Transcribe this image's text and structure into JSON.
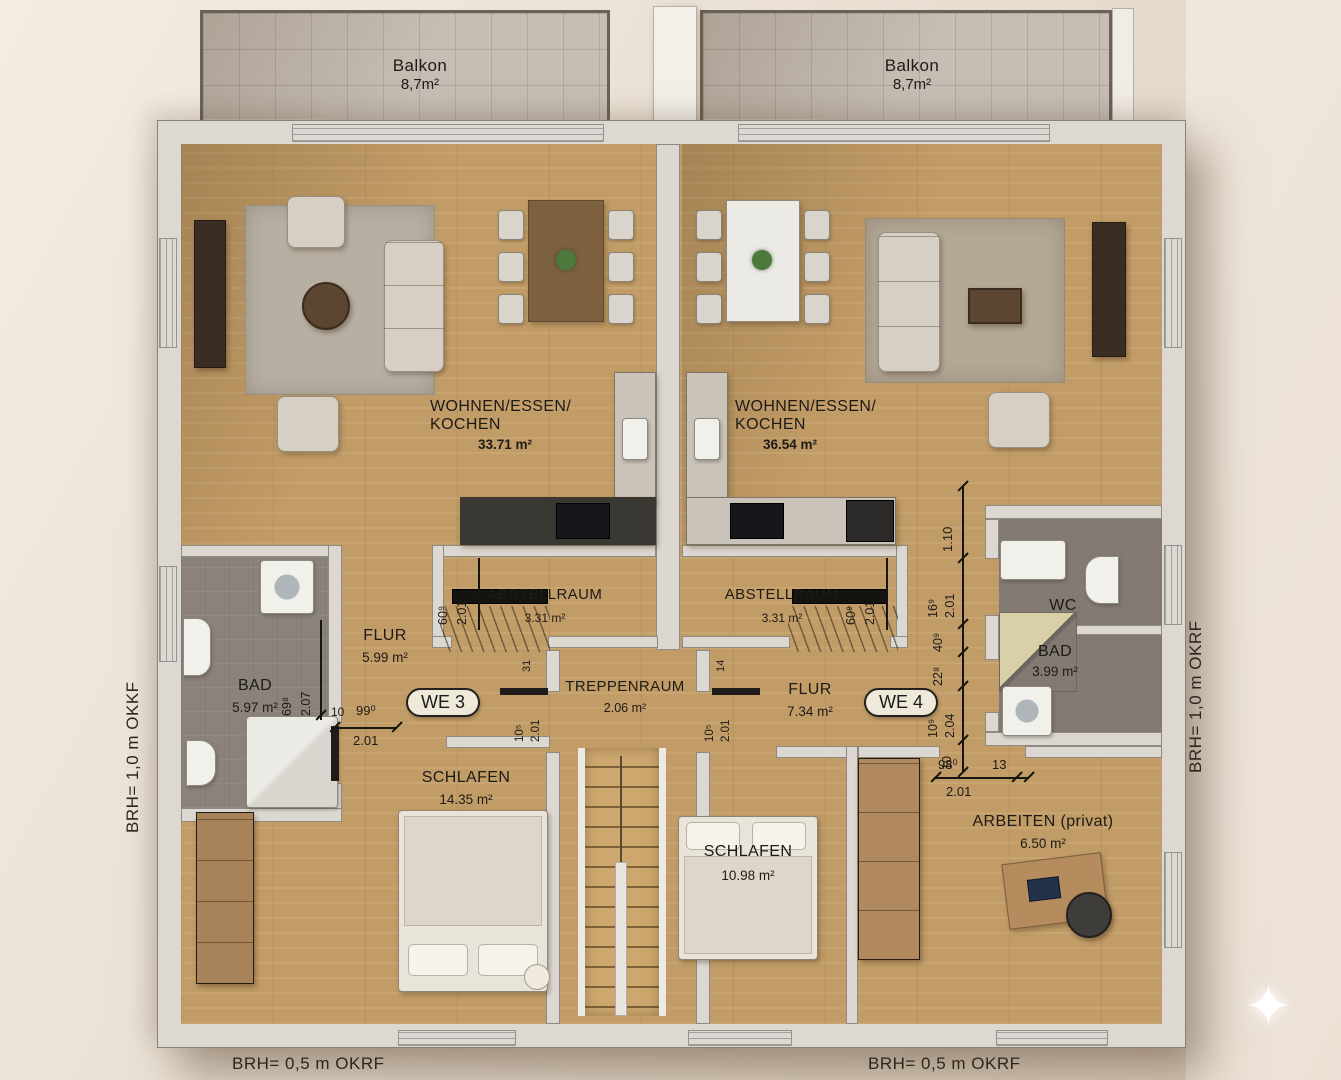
{
  "balconies": {
    "left": {
      "name": "Balkon",
      "area": "8,7m²"
    },
    "right": {
      "name": "Balkon",
      "area": "8,7m²"
    }
  },
  "units": {
    "left": "WE 3",
    "right": "WE 4"
  },
  "rooms": {
    "living_left": {
      "name1": "WOHNEN/ESSEN/",
      "name2": "KOCHEN",
      "area": "33.71 m²"
    },
    "living_right": {
      "name1": "WOHNEN/ESSEN/",
      "name2": "KOCHEN",
      "area": "36.54 m²"
    },
    "abstell_left": {
      "name": "ABSTELLRAUM",
      "area": "3.31 m²"
    },
    "abstell_right": {
      "name": "ABSTELLRAUM",
      "area": "3.31 m²"
    },
    "flur_left": {
      "name": "FLUR",
      "area": "5.99 m²"
    },
    "flur_right": {
      "name": "FLUR",
      "area": "7.34 m²"
    },
    "bad_left": {
      "name": "BAD",
      "area": "5.97 m²"
    },
    "bad_right": {
      "name": "BAD",
      "area": "3.99 m²"
    },
    "wc_right": {
      "name": "WC"
    },
    "treppenraum": {
      "name": "TREPPENRAUM",
      "area": "2.06 m²"
    },
    "schlafen_left": {
      "name": "SCHLAFEN",
      "area": "14.35 m²"
    },
    "schlafen_right": {
      "name": "SCHLAFEN",
      "area": "10.98 m²"
    },
    "arbeiten": {
      "name": "ARBEITEN (privat)",
      "area": "6.50 m²"
    }
  },
  "dims": {
    "abstell_left_w": "60⁹",
    "abstell_left_h": "2.01",
    "abstell_right_w": "60⁹",
    "abstell_right_h": "2.01",
    "bad_left_w": "69⁸",
    "bad_left_h": "2.07",
    "schlafen_left_off": "10",
    "schlafen_left_w": "99⁰",
    "schlafen_left_h": "2.01",
    "stair_left_off": "31",
    "stair_left_w": "10⁵",
    "stair_left_h": "2.01",
    "stair_right_off": "14",
    "stair_right_w": "10⁵",
    "stair_right_h": "2.01",
    "chain_top": "1.10",
    "chain_w1": "16⁹",
    "chain_h1": "2.01",
    "chain_w2": "40⁹",
    "chain_w3": "22⁸",
    "chain_w4": "10⁹",
    "chain_h4": "2.04",
    "chain_off": "10",
    "arbeiten_w": "98⁰",
    "arbeiten_off": "13",
    "arbeiten_h": "2.01"
  },
  "notes": {
    "left_side": "BRH= 1,0 m OKKF",
    "right_side": "BRH= 1,0 m OKRF",
    "bottom_left": "BRH= 0,5 m OKRF",
    "bottom_right": "BRH= 0,5 m OKRF"
  },
  "icons": {
    "sparkle": "✦"
  },
  "colors": {
    "wood_floor": "#c29c66",
    "bath_floor": "#8b837b",
    "wall": "#dcd8d1",
    "balcony_floor": "#c6beb4",
    "background": "#eae2d6",
    "text": "#1d1b18"
  }
}
